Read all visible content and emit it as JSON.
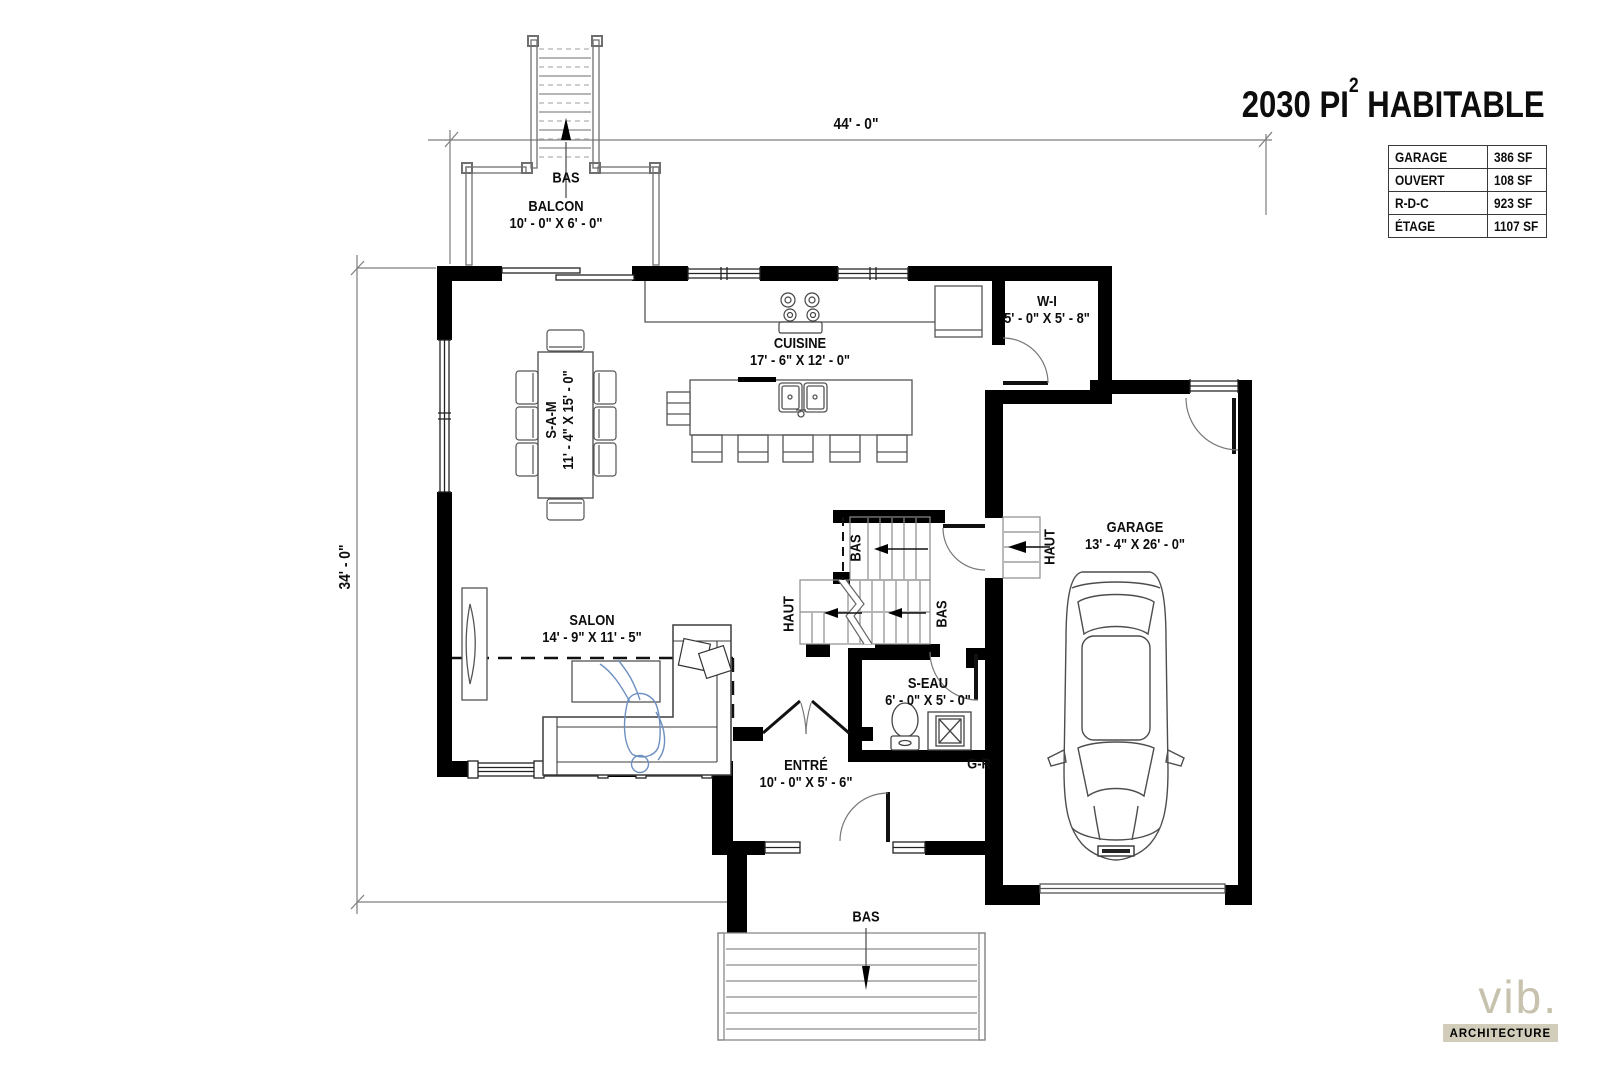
{
  "title": {
    "prefix": "2030 PI",
    "sup": "2",
    "suffix": " HABITABLE"
  },
  "area_table": {
    "rows": [
      {
        "label": "GARAGE",
        "value": "386 SF"
      },
      {
        "label": "OUVERT",
        "value": "108 SF"
      },
      {
        "label": "R-D-C",
        "value": "923 SF"
      },
      {
        "label": "ÉTAGE",
        "value": "1107 SF"
      }
    ]
  },
  "dimensions": {
    "top": "44' - 0\"",
    "left": "34' - 0\""
  },
  "rooms": {
    "balcon": {
      "name": "BALCON",
      "dims": "10' - 0\" X 6' - 0\""
    },
    "cuisine": {
      "name": "CUISINE",
      "dims": "17' - 6\" X 12' - 0\""
    },
    "walk_in": {
      "name": "W-I",
      "dims": "5' - 0\" X 5' - 8\""
    },
    "salle_a_manger": {
      "name": "S-A-M",
      "dims": "11' - 4\" X 15' - 0\""
    },
    "salon": {
      "name": "SALON",
      "dims": "14' - 9\" X 11' - 5\""
    },
    "salle_eau": {
      "name": "S-EAU",
      "dims": "6' - 0\" X 5' - 0\""
    },
    "entree": {
      "name": "ENTRÉ",
      "dims": "10' - 0\" X 5' - 6\""
    },
    "garage": {
      "name": "GARAGE",
      "dims": "13' - 4\" X 26' - 0\""
    },
    "garde_robe": {
      "name": "G-R"
    }
  },
  "stairs": {
    "balcony_down": "BAS",
    "mid_down": "BAS",
    "mid_up": "HAUT",
    "mid_down2": "BAS",
    "garage_up": "HAUT",
    "entry_down": "BAS"
  },
  "logo": {
    "name": "vib.",
    "subtitle": "ARCHITECTURE"
  },
  "colors": {
    "wall": "#000000",
    "line": "#777777",
    "logo_accent": "#c7c2ad",
    "badge_bg": "#d2cdbb",
    "person": "#6d8fc0"
  }
}
